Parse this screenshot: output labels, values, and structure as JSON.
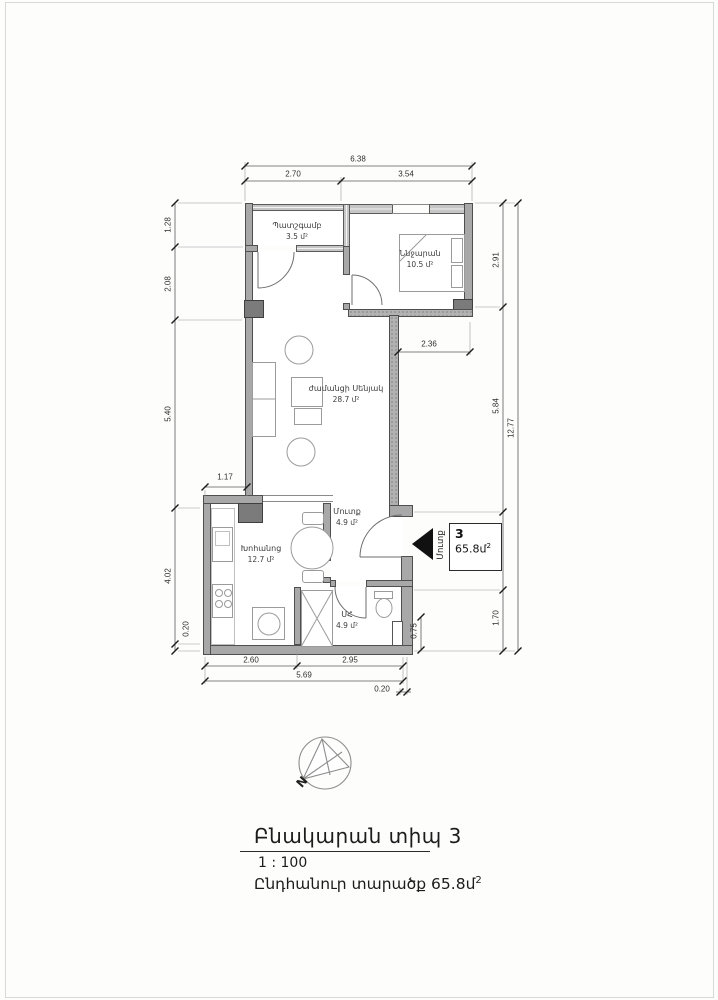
{
  "rooms": {
    "balcony": {
      "name": "Պատշգամբ",
      "area": "3.5 մ²"
    },
    "bedroom": {
      "name": "Ննջարան",
      "area": "10.5 մ²"
    },
    "living": {
      "name": "ժամանցի Սենյակ",
      "area": "28.7 մ²"
    },
    "kitchen": {
      "name": "Խոհանոց",
      "area": "12.7 մ²"
    },
    "hall": {
      "name": "Մուտք",
      "area": "4.9 մ²"
    },
    "bath": {
      "name": "ՍՀ",
      "area": "4.9 մ²"
    }
  },
  "dims": {
    "top_total": "6.38",
    "top_seg1": "2.70",
    "top_seg2": "3.54",
    "left1": "1.28",
    "left2": "2.08",
    "left3": "5.40",
    "left4": "4.02",
    "left5": "0.20",
    "right1": "2.91",
    "right2": "5.84",
    "right3": "2.18",
    "right4": "1.70",
    "right_total": "12.77",
    "right_small": "0.75",
    "bottom1": "2.60",
    "bottom2": "2.95",
    "bottom_total": "5.69",
    "bottom_small": "0.20",
    "inner1": "1.17",
    "inner2": "2.36"
  },
  "entry": {
    "direction_label": "Մուտք",
    "unit_number": "3",
    "unit_area": "65.8մ",
    "unit_area_sup": "2"
  },
  "compass": {
    "north": "N"
  },
  "title_block": {
    "title": "Բնակարան տիպ 3",
    "scale": "1 : 100",
    "area_text": "Ընդհանուր տարածք 65.8մ",
    "area_sup": "2"
  }
}
